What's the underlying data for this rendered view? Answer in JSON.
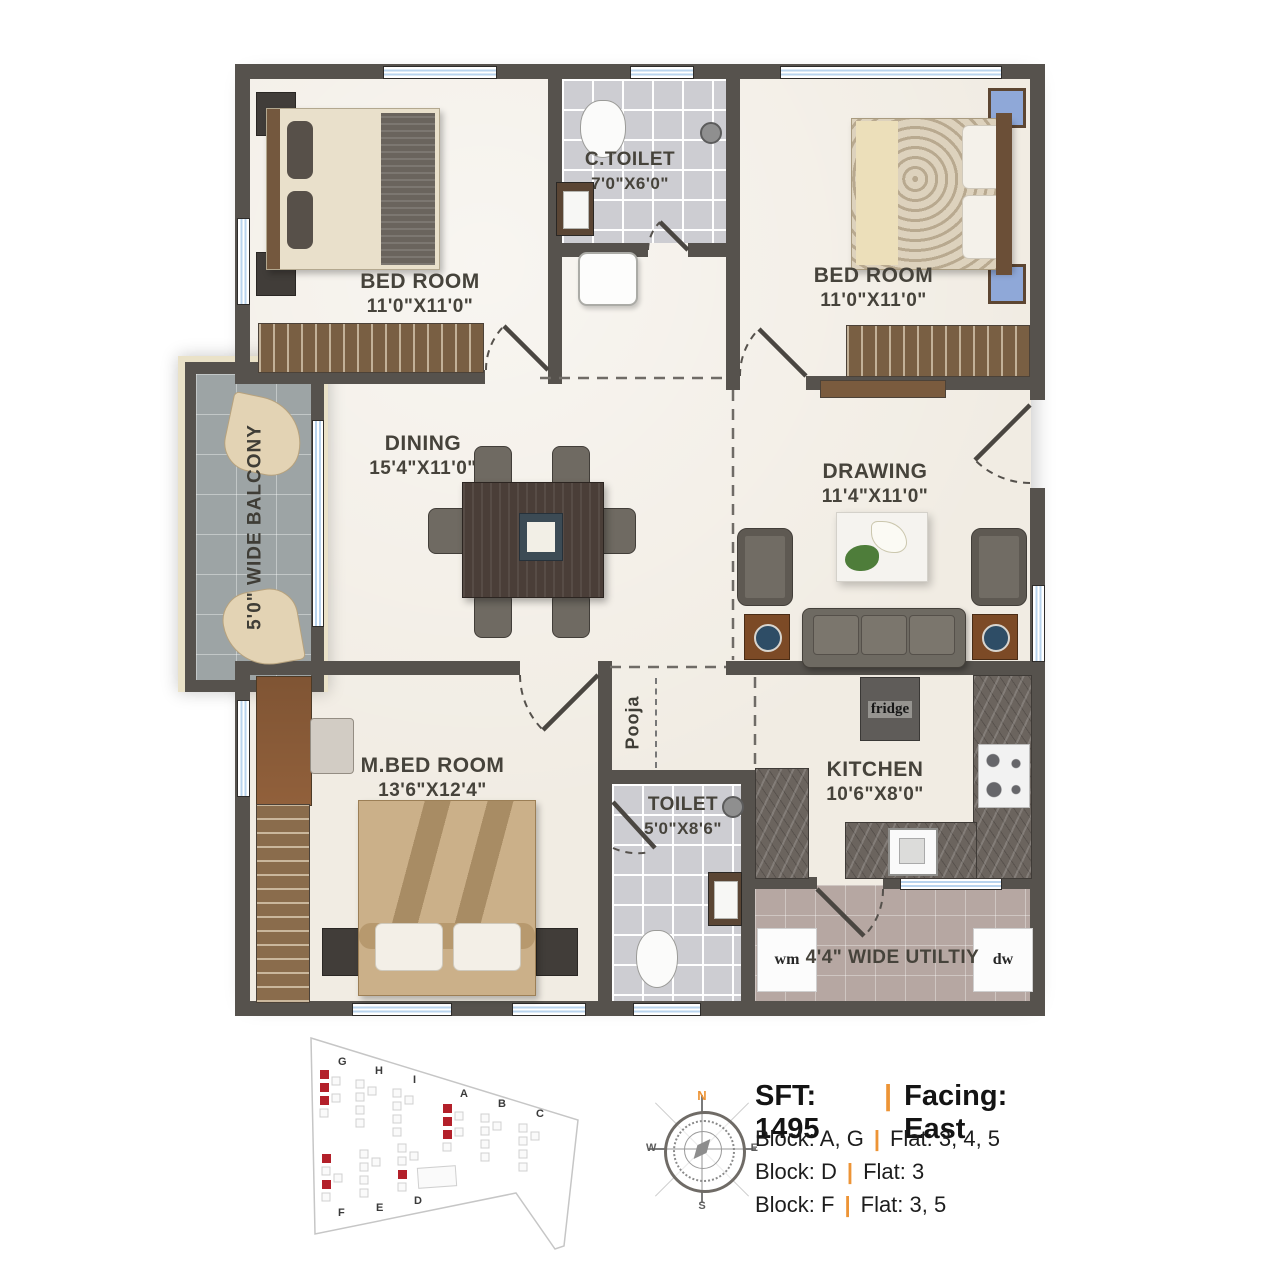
{
  "plan": {
    "rooms": {
      "bedroom1": {
        "name": "BED ROOM",
        "dim": "11'0\"X11'0\""
      },
      "ctoilet": {
        "name": "C.TOILET",
        "dim": "7'0\"X6'0\""
      },
      "bedroom2": {
        "name": "BED ROOM",
        "dim": "11'0\"X11'0\""
      },
      "balcony": {
        "name": "5'0\" WIDE BALCONY"
      },
      "dining": {
        "name": "DINING",
        "dim": "15'4\"X11'0\""
      },
      "drawing": {
        "name": "DRAWING",
        "dim": "11'4\"X11'0\""
      },
      "mbedroom": {
        "name": "M.BED ROOM",
        "dim": "13'6\"X12'4\""
      },
      "pooja": {
        "name": "Pooja"
      },
      "toilet": {
        "name": "TOILET",
        "dim": "5'0\"X8'6\""
      },
      "kitchen": {
        "name": "KITCHEN",
        "dim": "10'6\"X8'0\""
      },
      "utility": {
        "name": "4'4\" WIDE UTILTIY"
      }
    },
    "appliances": {
      "fridge": "fridge",
      "wm": "wm",
      "dw": "dw"
    }
  },
  "compass": {
    "n": "N",
    "e": "E",
    "w": "W",
    "s": "S"
  },
  "info": {
    "sft": "SFT: 1495",
    "facing": "Facing: East",
    "divider": "|",
    "rows": [
      {
        "block": "Block: A, G",
        "flat": "Flat: 3, 4, 5"
      },
      {
        "block": "Block: D",
        "flat": "Flat: 3"
      },
      {
        "block": "Block: F",
        "flat": "Flat: 3, 5"
      }
    ]
  },
  "sitemap": {
    "blocks": [
      "G",
      "H",
      "I",
      "A",
      "B",
      "C",
      "F",
      "E",
      "D"
    ],
    "highlight_color": "#B3202A"
  },
  "colors": {
    "accent": "#ED9436",
    "wall": "#56524D",
    "highlight": "#B3202A"
  }
}
